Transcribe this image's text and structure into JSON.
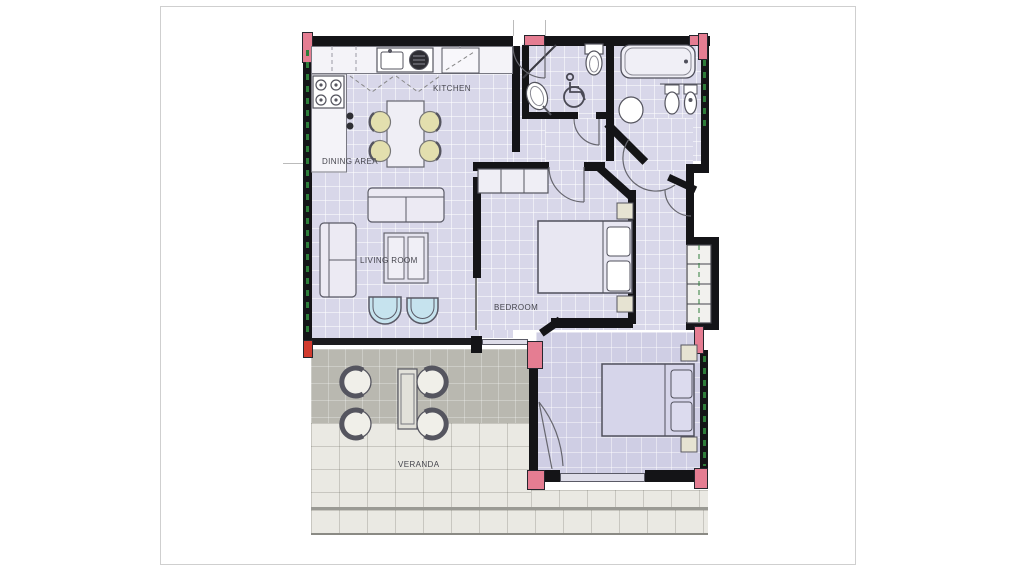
{
  "figure": {
    "type": "architectural-floor-plan",
    "page_background": "#ffffff",
    "page_border_color": "#cfcfcf"
  },
  "palette": {
    "wall": "#141417",
    "column_pink": "#e57d92",
    "accent_red": "#d23b2f",
    "floor_lavender": "#d8d7e9",
    "floor_bedroom2": "#cfcee4",
    "veranda_covered": "#b9b8b0",
    "veranda_tile": "#eae9e3",
    "dining_chair_seat": "#e3dfae",
    "armchair_seat": "#c6e3ee",
    "window_green": "#2e7d3a"
  },
  "rooms": {
    "kitchen": {
      "label": "KITCHEN"
    },
    "dining_area": {
      "label": "DINING AREA"
    },
    "living_room": {
      "label": "LIVING ROOM"
    },
    "bedroom_main": {
      "label": "BEDROOM"
    },
    "bedroom_small": {
      "label": "BEDROOM"
    },
    "veranda": {
      "label": "VERANDA"
    }
  },
  "icons": {
    "wheelchair_accessible": "wheelchair-icon"
  }
}
